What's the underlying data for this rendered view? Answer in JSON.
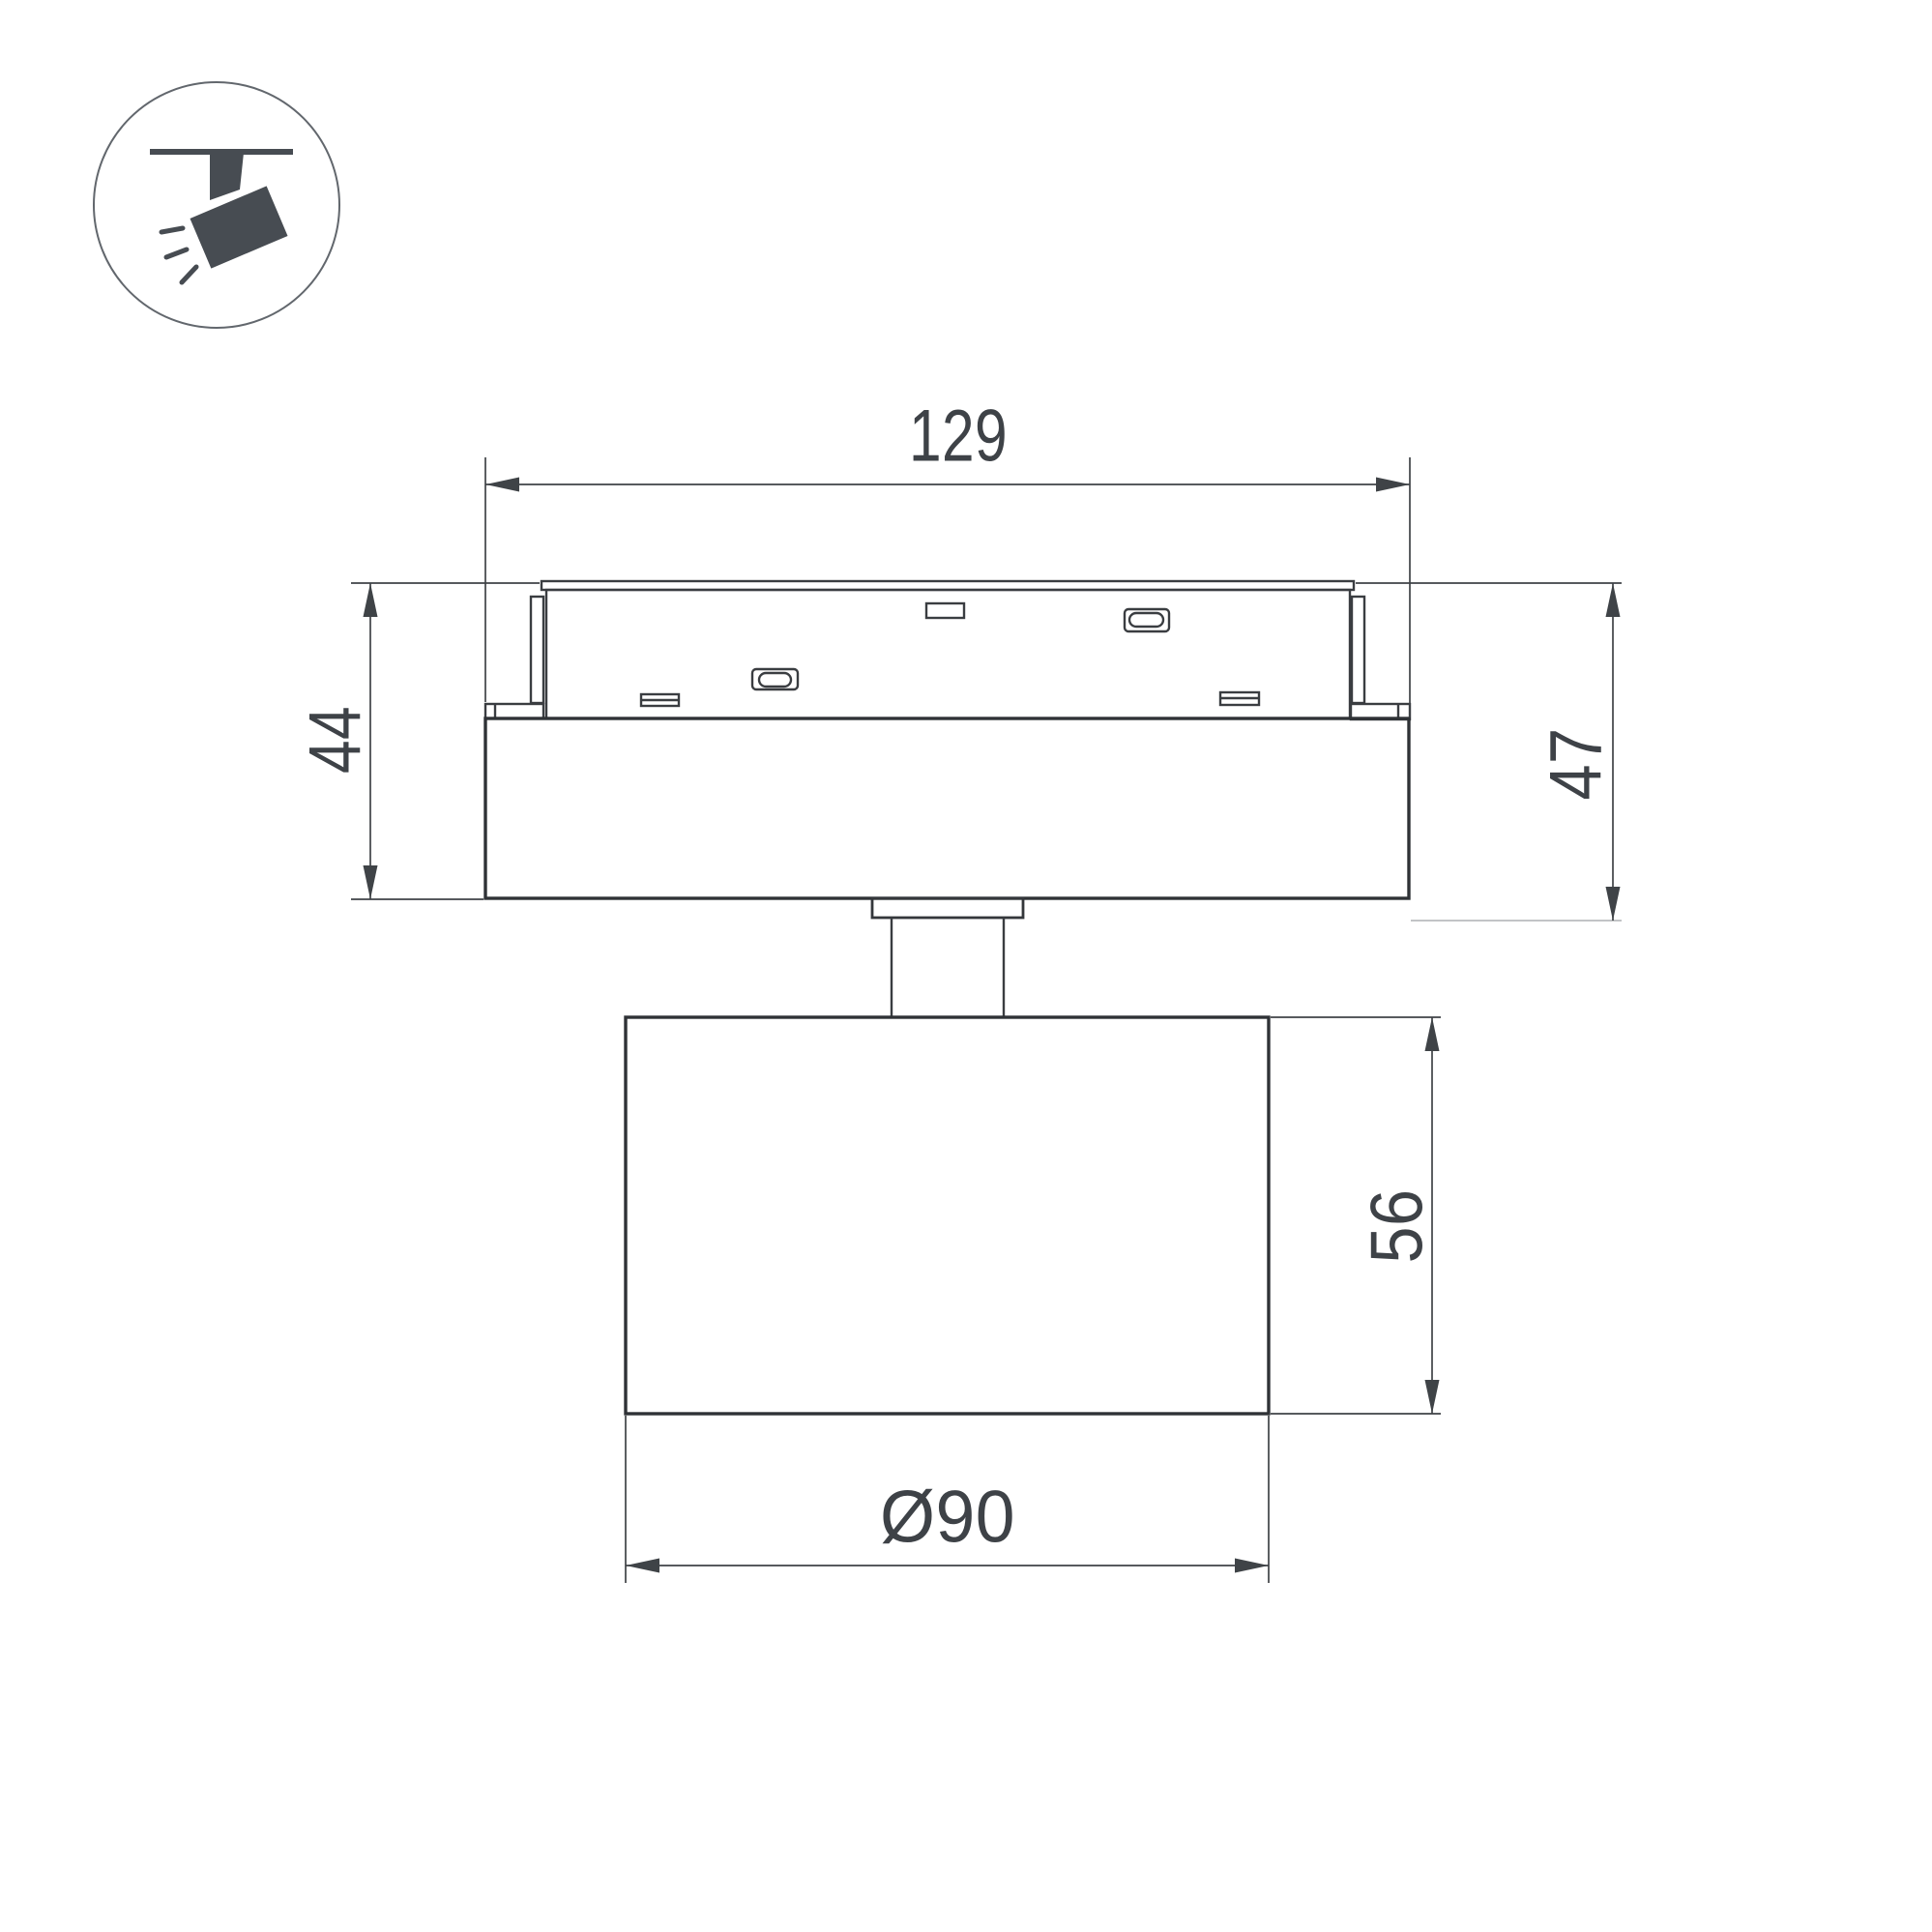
{
  "page": {
    "background": "#ffffff"
  },
  "icon": {
    "name": "ceiling-track-spotlight-pictogram",
    "glyph_color": "#474c52",
    "ring_color": "#62676d"
  },
  "drawing": {
    "outline_color": "#34373b",
    "dimension_color": "#3f4347",
    "light_extension_color": "#b9bcbe",
    "text_color": "#3e4247"
  },
  "dimensions": {
    "track_width": "129",
    "module_height_left": "44",
    "overall_height_right": "47",
    "head_height": "56",
    "head_diameter": "Ø90"
  }
}
